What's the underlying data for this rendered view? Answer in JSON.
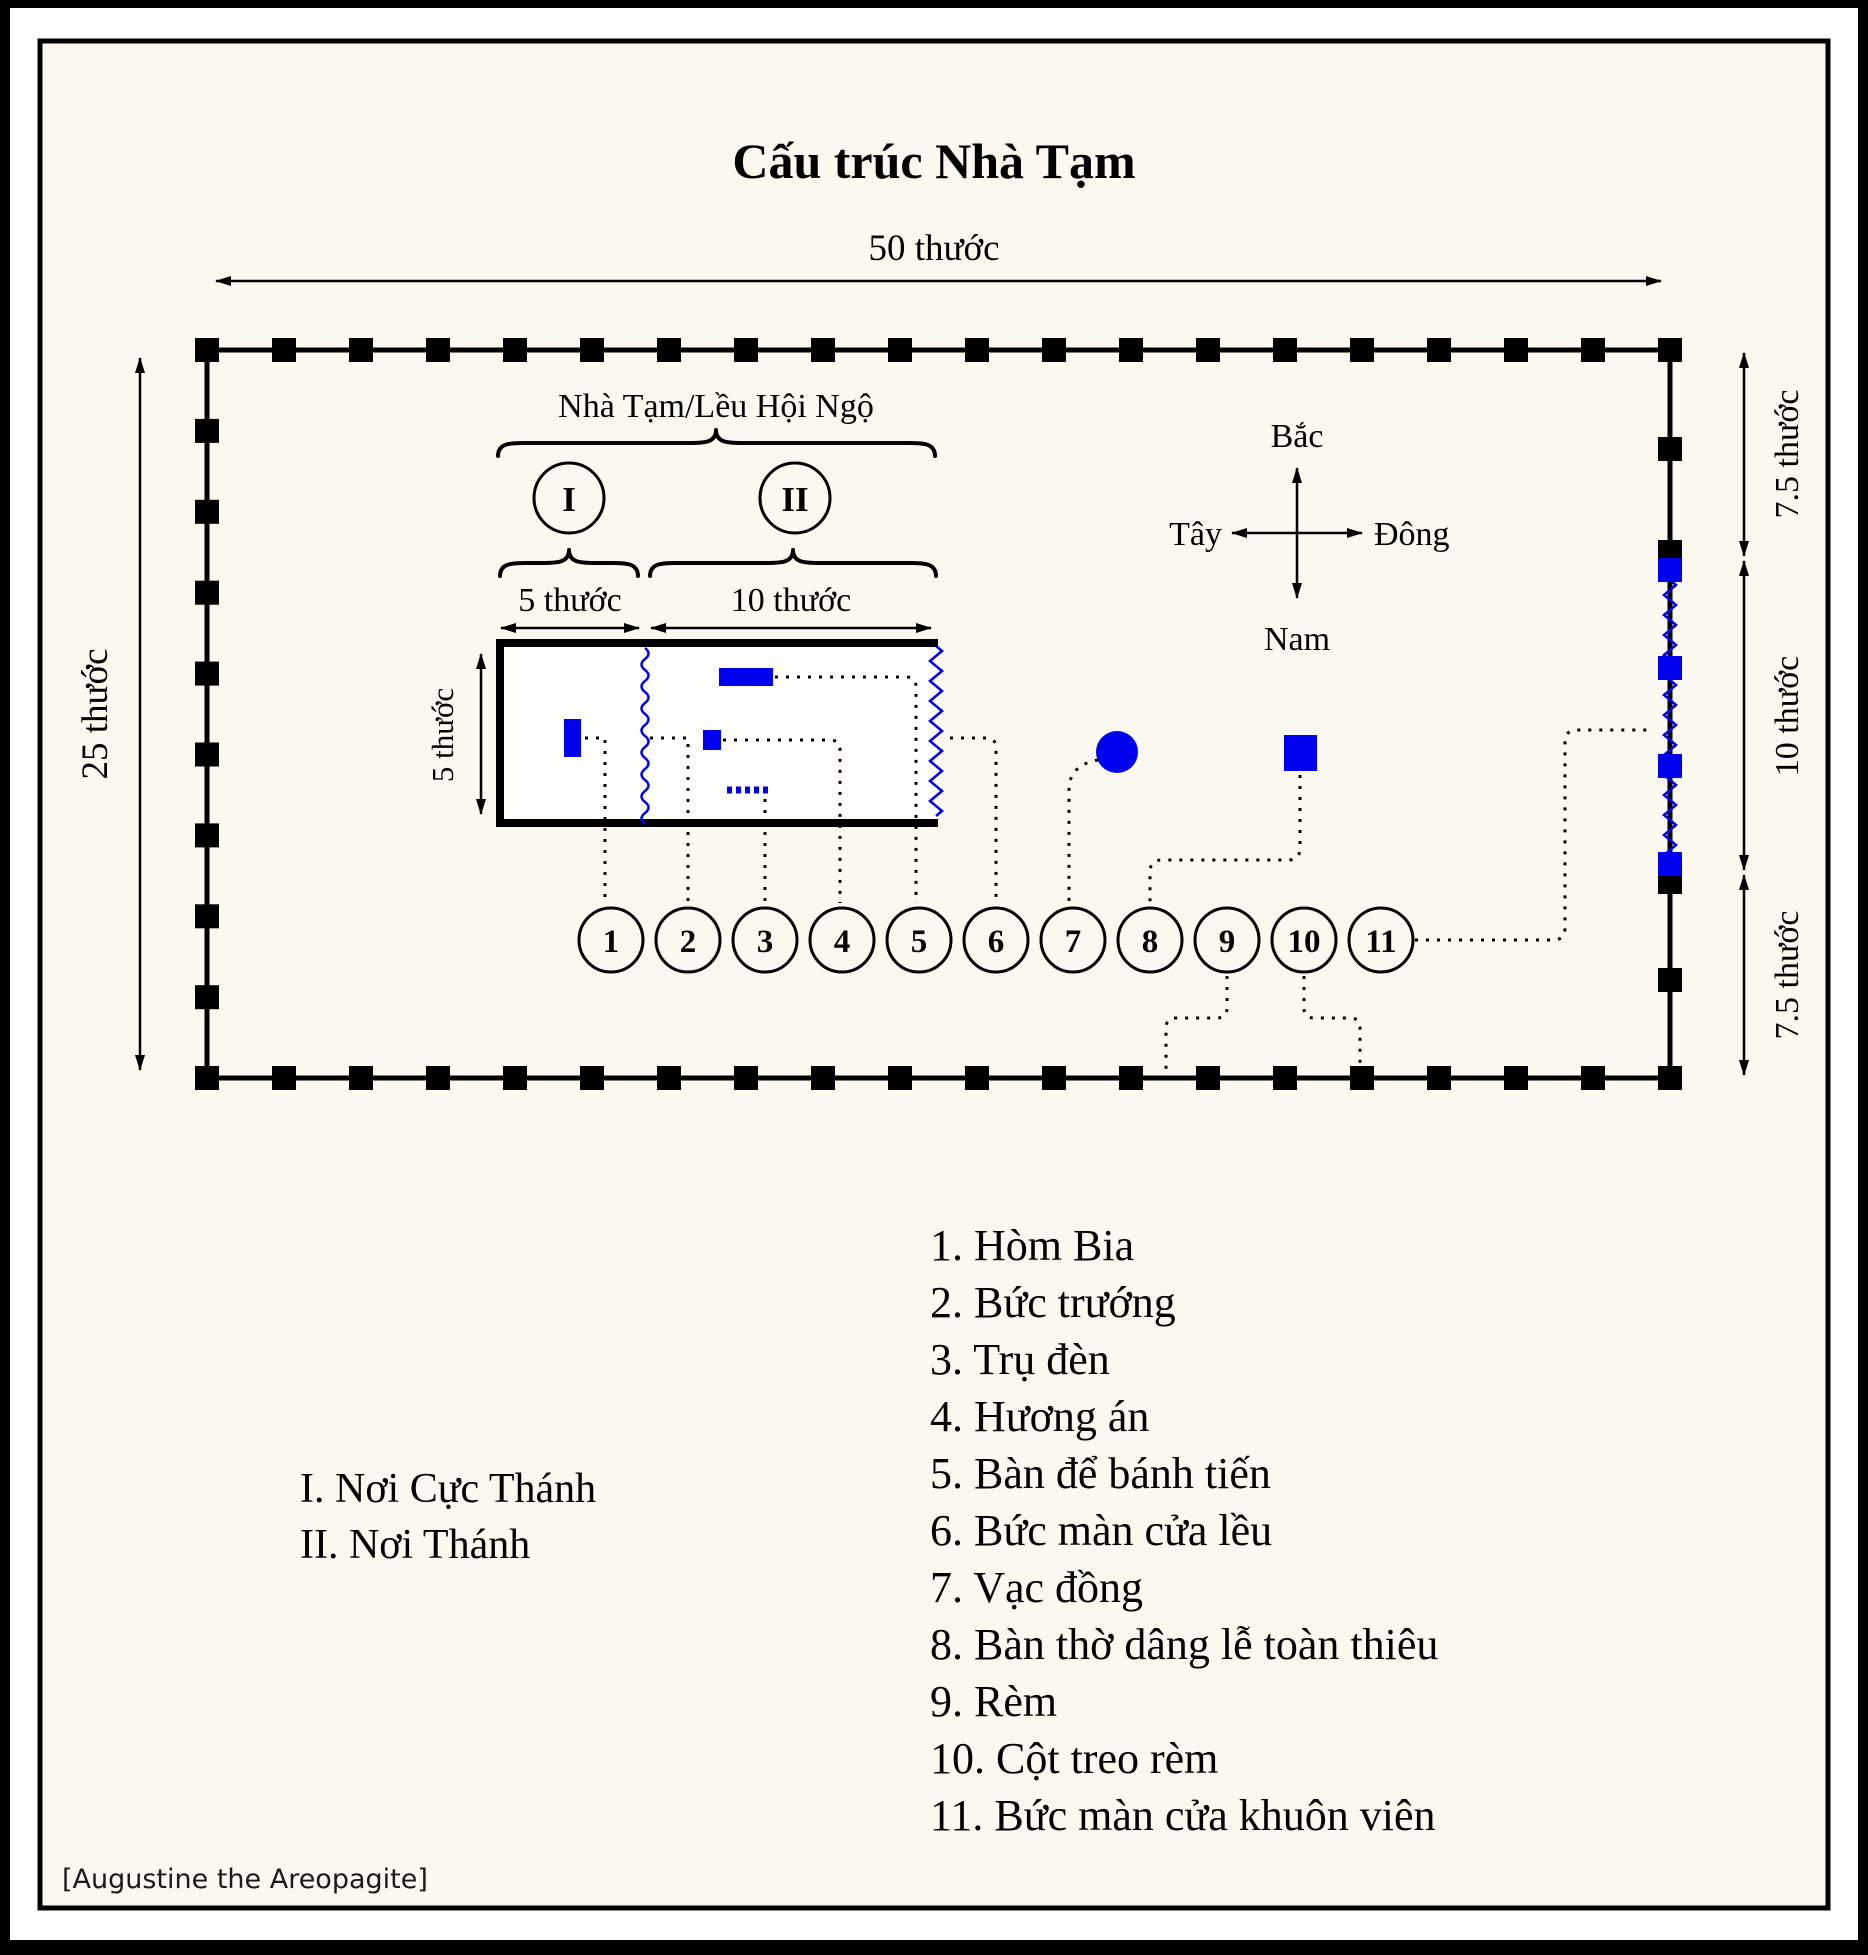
{
  "title": "Cấu trúc Nhà Tạm",
  "attribution": "[Augustine the Areopagite]",
  "dimensions": {
    "courtyard_width": "50 thước",
    "courtyard_height": "25 thước",
    "east_top": "7.5 thước",
    "east_gate": "10 thước",
    "east_bottom": "7.5 thước",
    "tent_zone1_width": "5 thước",
    "tent_zone2_width": "10 thước",
    "tent_depth": "5 thước"
  },
  "compass": {
    "north": "Bắc",
    "south": "Nam",
    "west": "Tây",
    "east": "Đông"
  },
  "tent_label": "Nhà Tạm/Lều Hội Ngộ",
  "zones": [
    {
      "num": "I",
      "name": "I. Nơi Cực Thánh"
    },
    {
      "num": "II",
      "name": "II. Nơi Thánh"
    }
  ],
  "callouts": [
    "1",
    "2",
    "3",
    "4",
    "5",
    "6",
    "7",
    "8",
    "9",
    "10",
    "11"
  ],
  "legend": {
    "items": [
      {
        "text": "1. Hòm Bia"
      },
      {
        "text": "2. Bức trướng"
      },
      {
        "text": "3. Trụ đèn"
      },
      {
        "text": "4. Hương án"
      },
      {
        "text": "5. Bàn để bánh tiến"
      },
      {
        "text": "6. Bức màn cửa lều"
      },
      {
        "text": "7. Vạc đồng"
      },
      {
        "text": "8. Bàn thờ dâng lễ toàn thiêu"
      },
      {
        "text": "9. Rèm"
      },
      {
        "text": "10. Cột treo rèm"
      },
      {
        "text": "11. Bức màn cửa khuôn viên"
      }
    ]
  },
  "colors": {
    "accent": "#0000EE",
    "ink": "#000000",
    "paper": "#FAF8EF"
  }
}
